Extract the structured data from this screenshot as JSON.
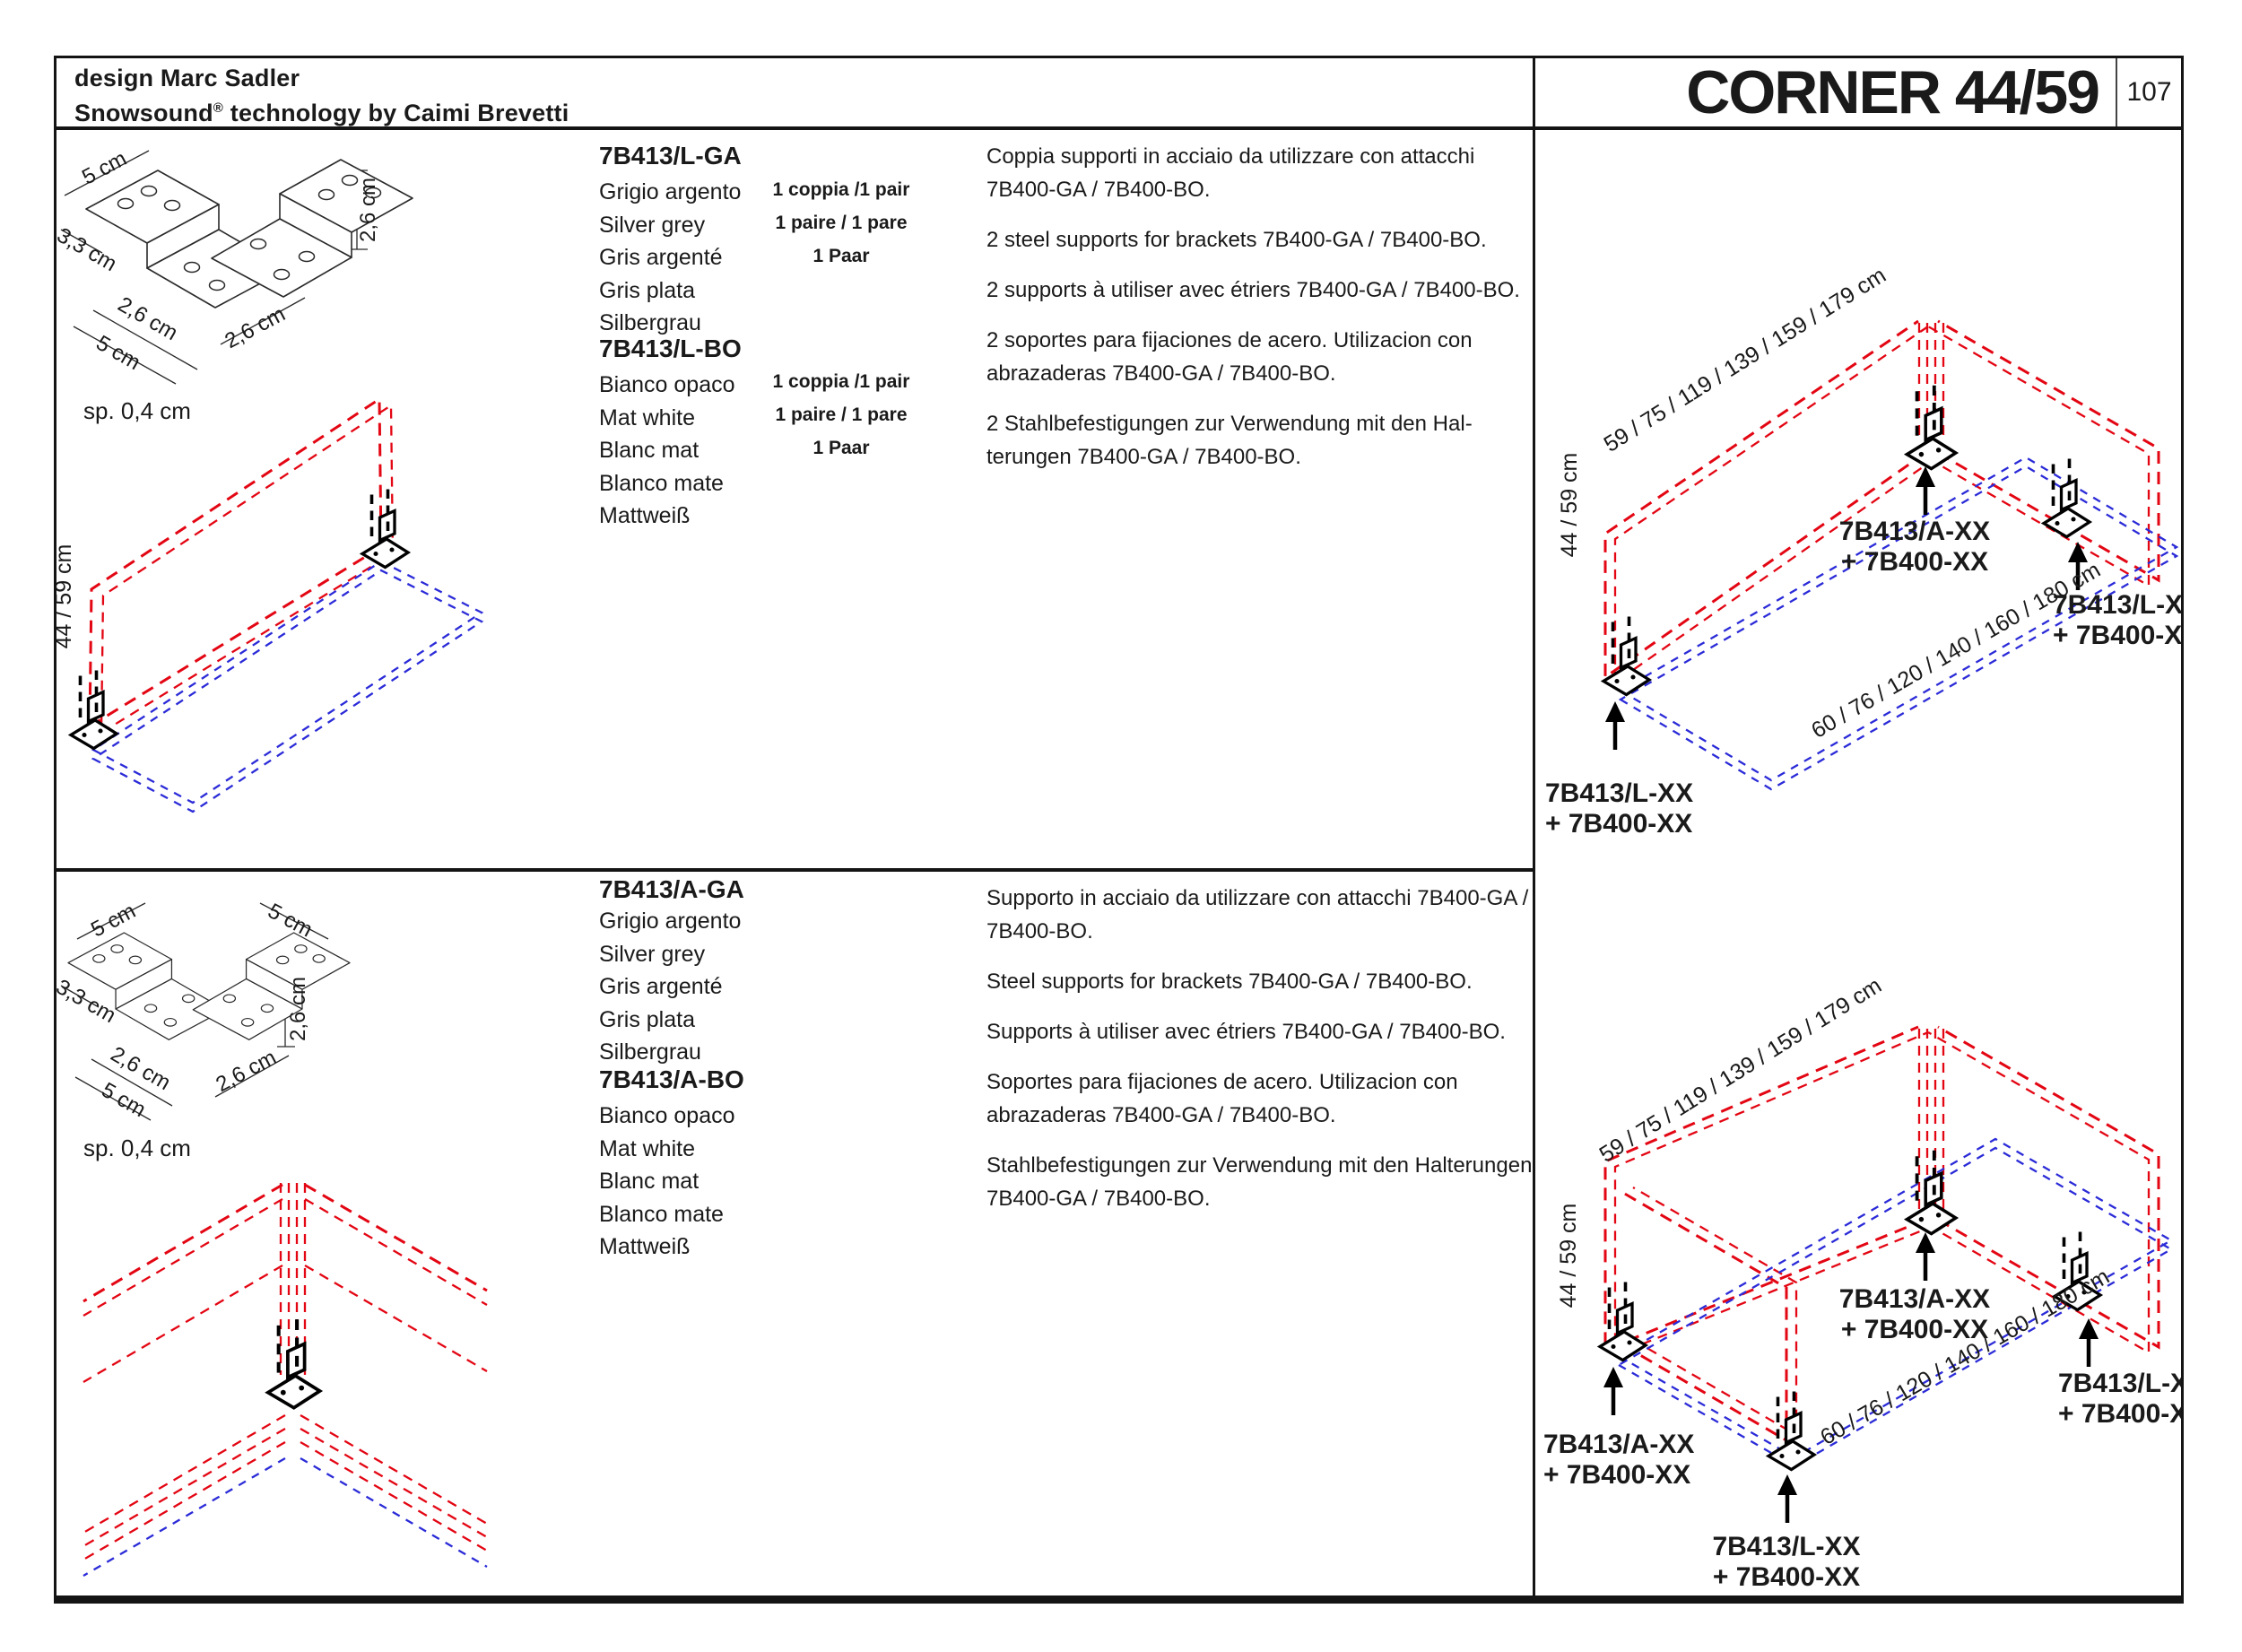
{
  "header": {
    "design_line": "design Marc Sadler",
    "brand_prefix": "Snowsound",
    "brand_reg": "®",
    "brand_suffix": " technology by Caimi Brevetti",
    "title": "CORNER 44/59",
    "page_number": "107"
  },
  "colors": {
    "accent_red": "#E30613",
    "accent_blue": "#2B2BD8",
    "ink": "#1a1a1a"
  },
  "sections": [
    {
      "drawing_dims": [
        "5 cm",
        "3,3 cm",
        "2,6 cm",
        "5 cm",
        "2,6 cm",
        "2,6 cm"
      ],
      "thickness_label": "sp. 0,4 cm",
      "iso_height_label": "44 / 59 cm",
      "products": [
        {
          "code": "7B413/L-GA",
          "colors": [
            "Grigio argento",
            "Silver grey",
            "Gris argenté",
            "Gris plata",
            "Silbergrau"
          ],
          "quantity": [
            "1 coppia /1 pair",
            "1 paire / 1 pare",
            "1 Paar"
          ]
        },
        {
          "code": "7B413/L-BO",
          "colors": [
            "Bianco opaco",
            "Mat white",
            "Blanc mat",
            "Blanco mate",
            "Mattweiß"
          ],
          "quantity": [
            "1 coppia /1 pair",
            "1 paire / 1 pare",
            "1 Paar"
          ]
        }
      ],
      "descriptions": [
        "Coppia supporti in acciaio da utilizzare con attacchi 7B400-GA / 7B400-BO.",
        "2 steel supports for brackets 7B400-GA / 7B400-BO.",
        "2 supports à utiliser avec étriers 7B400-GA / 7B400-BO.",
        "2 soportes para fijaciones de acero. Utilizacion con abrazaderas 7B400-GA / 7B400-BO.",
        "2 Stahlbefestigungen zur Verwendung mit den Hal­terungen 7B400-GA / 7B400-BO."
      ]
    },
    {
      "drawing_dims": [
        "5 cm",
        "5 cm",
        "3,3 cm",
        "2,6 cm",
        "5 cm",
        "2,6 cm",
        "2,6 cm"
      ],
      "thickness_label": "sp. 0,4 cm",
      "products": [
        {
          "code": "7B413/A-GA",
          "colors": [
            "Grigio argento",
            "Silver grey",
            "Gris argenté",
            "Gris plata",
            "Silbergrau"
          ]
        },
        {
          "code": "7B413/A-BO",
          "colors": [
            "Bianco opaco",
            "Mat white",
            "Blanc mat",
            "Blanco mate",
            "Mattweiß"
          ]
        }
      ],
      "descriptions": [
        "Supporto in acciaio da utilizzare con attacchi 7B400-GA / 7B400-BO.",
        "Steel supports for brackets 7B400-GA / 7B400-BO.",
        "Supports à utiliser avec étriers 7B400-GA / 7B400-BO.",
        "Soportes para fijaciones de acero. Utilizacion con abrazaderas 7B400-GA / 7B400-BO.",
        "Stahlbefestigungen zur Verwendung mit den Halte­rungen 7B400-GA / 7B400-BO."
      ]
    }
  ],
  "diagrams": [
    {
      "length_label": "59 / 75 / 119 / 139 / 159 / 179 cm",
      "height_label": "44 / 59 cm",
      "base_label": "60 / 76 / 120 / 140 / 160 / 180 cm",
      "center_label": [
        "7B413/A-XX",
        "+ 7B400-XX"
      ],
      "right_label": [
        "7B413/L-XX",
        "+ 7B400-XX"
      ],
      "left_label": [
        "7B413/L-XX",
        "+ 7B400-XX"
      ]
    },
    {
      "length_label": "59 / 75 / 119 / 139 / 159 / 179 cm",
      "height_label": "44 / 59 cm",
      "base_label": "60 / 76 / 120 / 140 / 160 / 180 cm",
      "center_label": [
        "7B413/A-XX",
        "+ 7B400-XX"
      ],
      "right_label": [
        "7B413/L-XX",
        "+ 7B400-XX"
      ],
      "left_label": [
        "7B413/A-XX",
        "+ 7B400-XX"
      ],
      "front_label": [
        "7B413/L-XX",
        "+ 7B400-XX"
      ]
    }
  ]
}
